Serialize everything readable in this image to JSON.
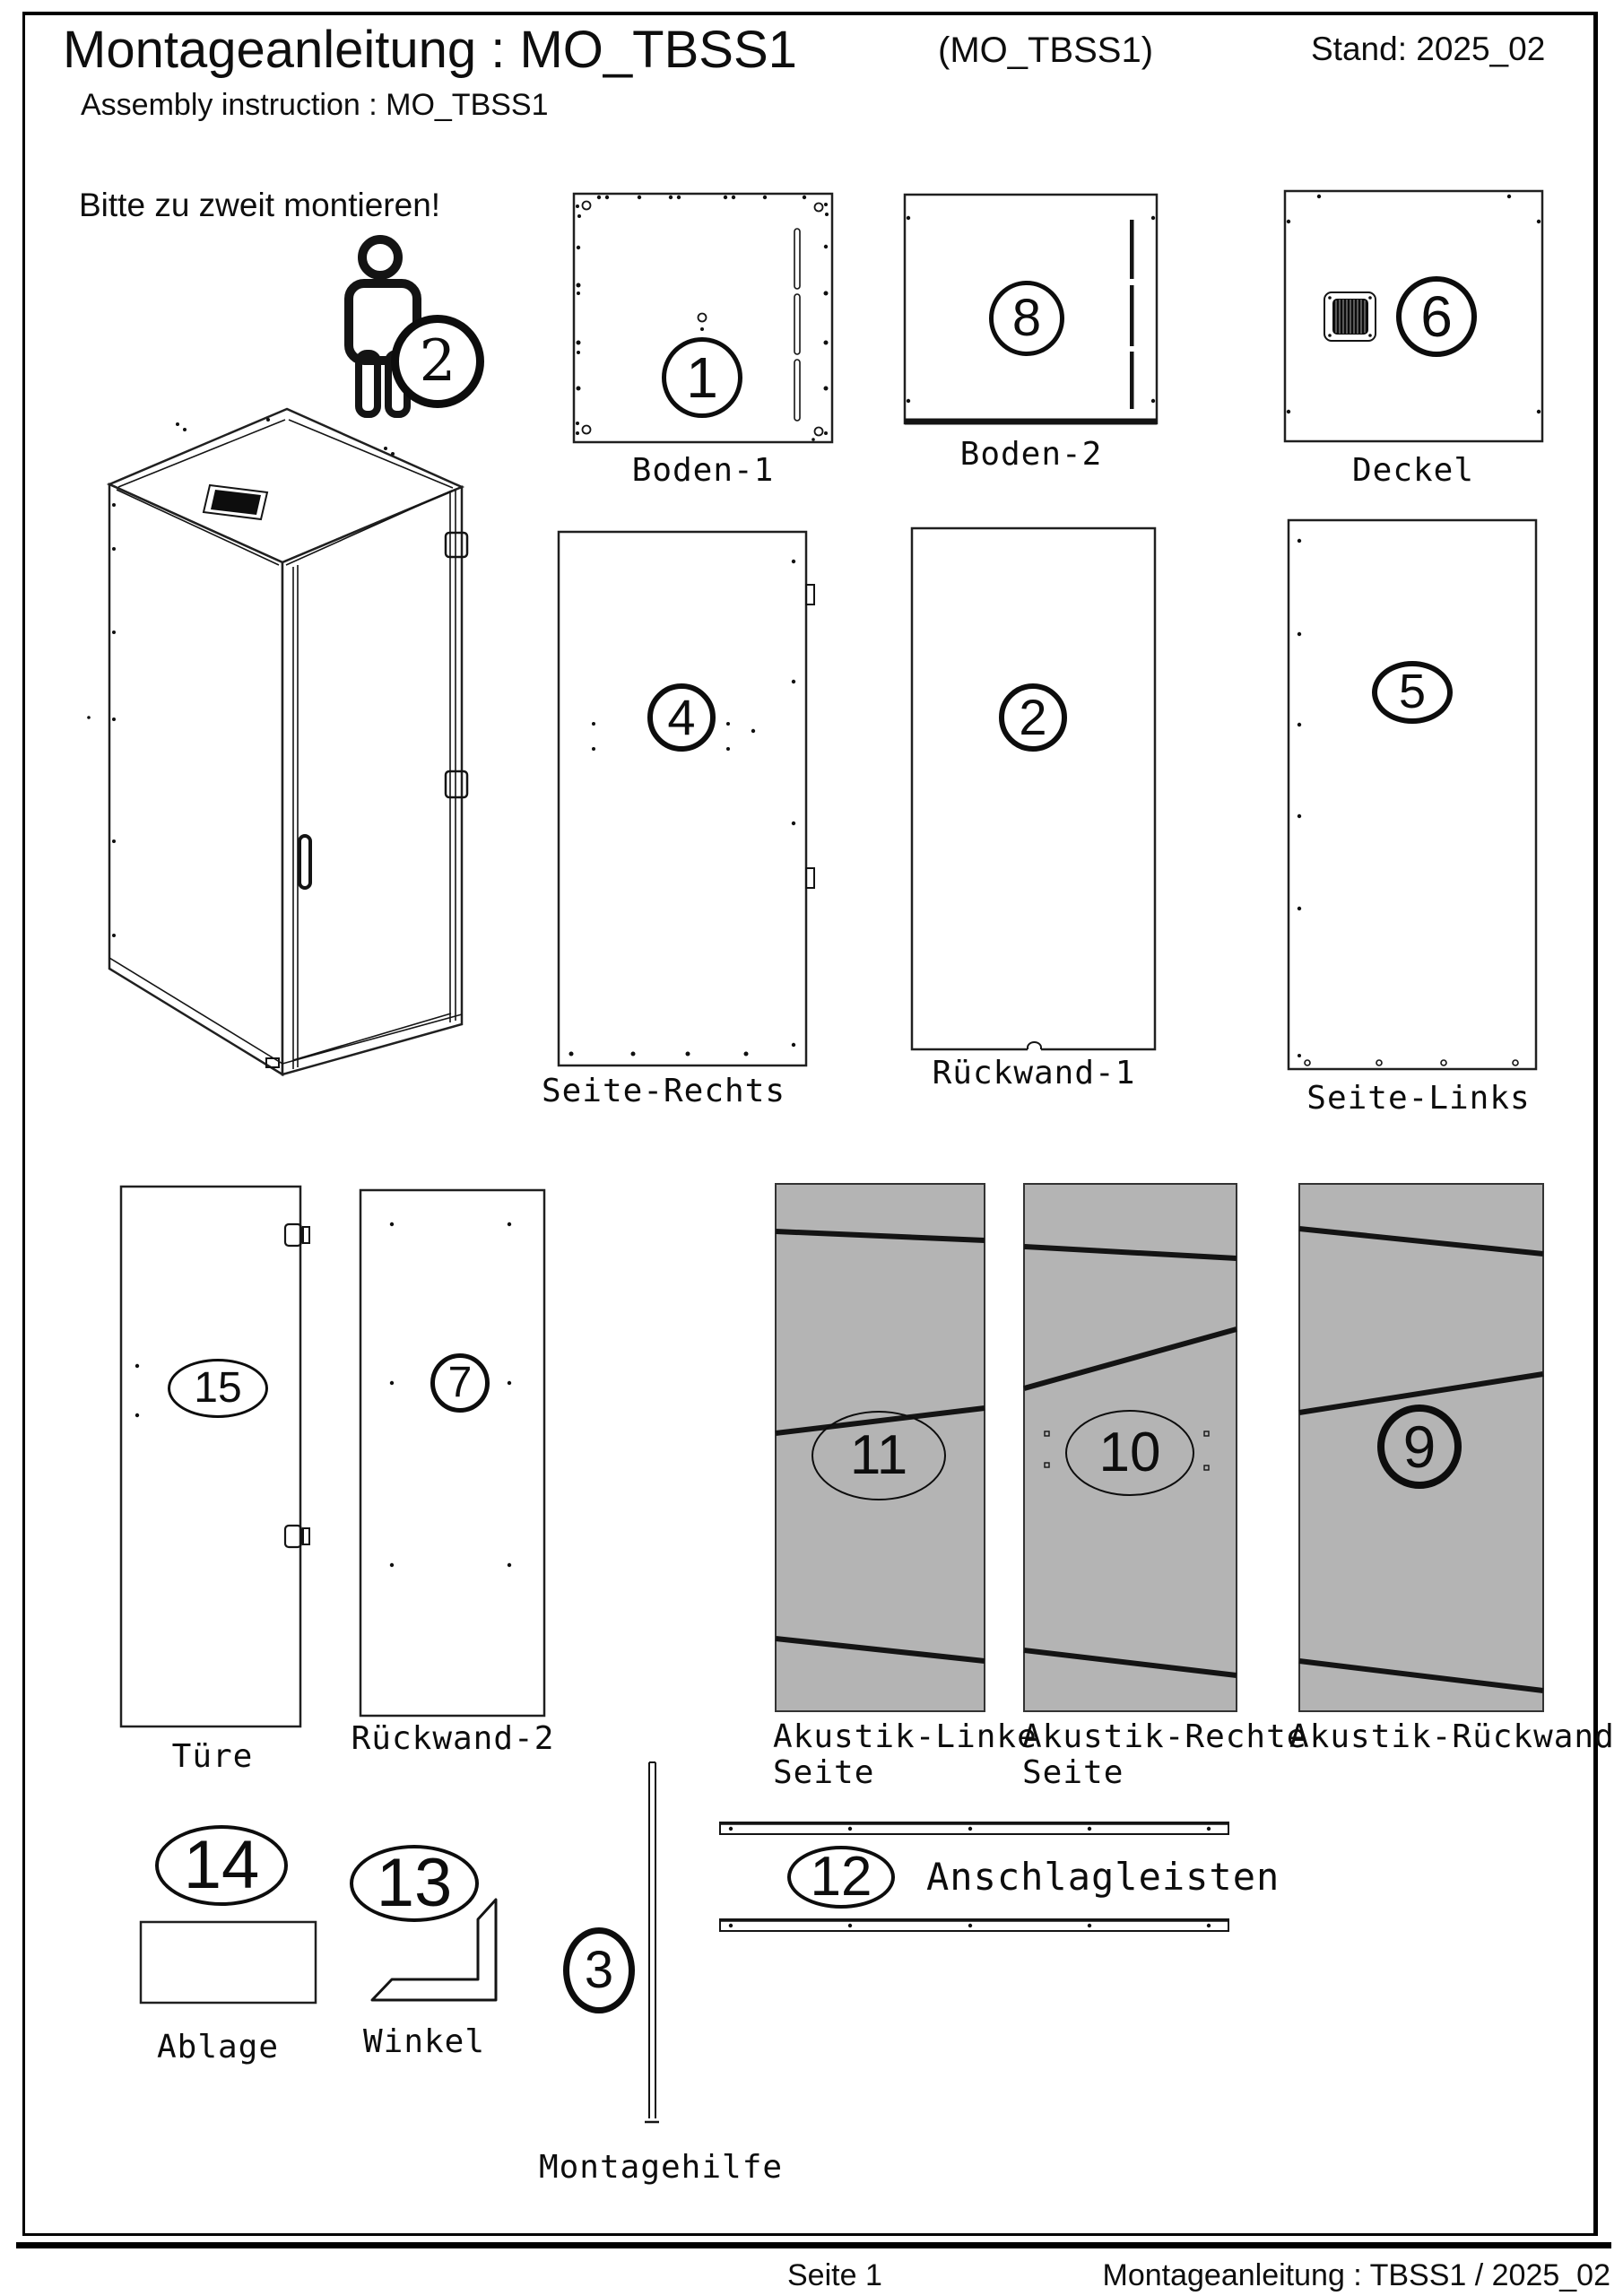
{
  "header": {
    "title": "Montageanleitung : MO_TBSS1",
    "variant": "(MO_TBSS1)",
    "stand": "Stand: 2025_02",
    "subtitle": "Assembly instruction : MO_TBSS1",
    "note": "Bitte zu zweit montieren!",
    "person_count": "2"
  },
  "parts": {
    "boden1": {
      "num": "1",
      "label": "Boden-1"
    },
    "boden2": {
      "num": "8",
      "label": "Boden-2"
    },
    "deckel": {
      "num": "6",
      "label": "Deckel"
    },
    "seite_rechts": {
      "num": "4",
      "label": "Seite-Rechts"
    },
    "rueckwand1": {
      "num": "2",
      "label": "Rückwand-1"
    },
    "seite_links": {
      "num": "5",
      "label": "Seite-Links"
    },
    "tuere": {
      "num": "15",
      "label": "Türe"
    },
    "rueckwand2": {
      "num": "7",
      "label": "Rückwand-2"
    },
    "akustik_linke": {
      "num": "11",
      "label_line1": "Akustik-Linke",
      "label_line2": "Seite"
    },
    "akustik_rechte": {
      "num": "10",
      "label_line1": "Akustik-Rechte",
      "label_line2": "Seite"
    },
    "akustik_rueckwand": {
      "num": "9",
      "label": "Akustik-Rückwand"
    },
    "ablage": {
      "num": "14",
      "label": "Ablage"
    },
    "winkel": {
      "num": "13",
      "label": "Winkel"
    },
    "montagehilfe": {
      "num": "3",
      "label": "Montagehilfe"
    },
    "anschlagleisten": {
      "num": "12",
      "label": "Anschlagleisten"
    }
  },
  "footer": {
    "page": "Seite 1",
    "doc": "Montageanleitung : TBSS1 / 2025_02"
  },
  "colors": {
    "panel_gray": "#b4b4b4",
    "line": "#111111"
  }
}
